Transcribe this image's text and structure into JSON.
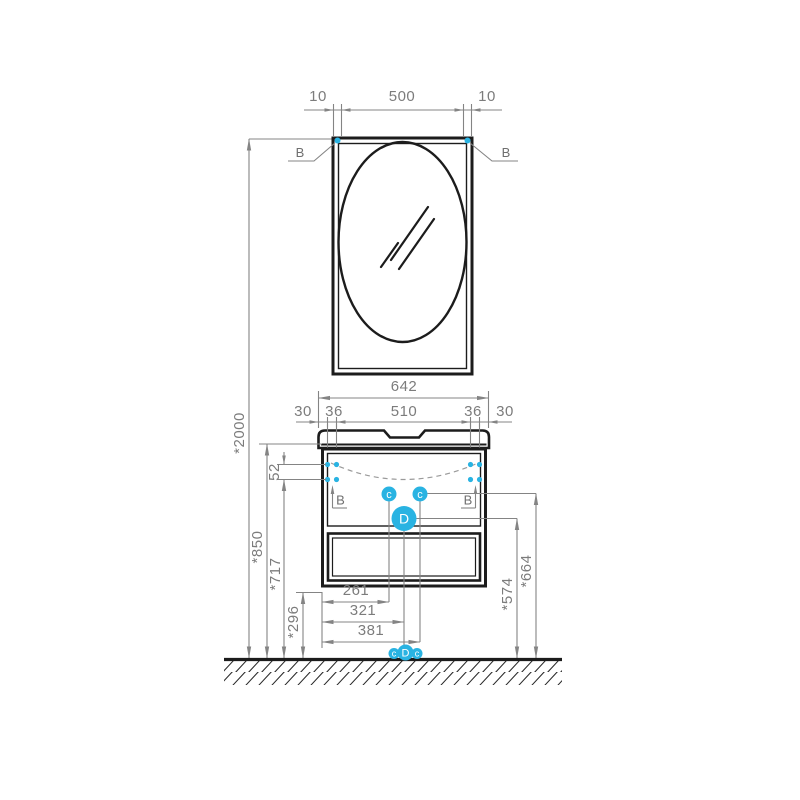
{
  "palette": {
    "accent": "#29b3e2",
    "ink": "#1c1c1c",
    "dim_gray": "#848484",
    "text_gray": "#7c7c7c"
  },
  "top_dims": {
    "left_offset": "10",
    "width": "500",
    "right_offset": "10"
  },
  "mirror": {
    "mount_left": "B",
    "mount_right": "B"
  },
  "width_dims": {
    "total": "642",
    "seg_30_l": "30",
    "seg_36_l": "36",
    "seg_510": "510",
    "seg_36_r": "36",
    "seg_30_r": "30"
  },
  "cabinet": {
    "mount_left": "B",
    "mount_right": "B",
    "supply_left": "c",
    "supply_right": "c",
    "drain": "D"
  },
  "height_dims": {
    "mirror_top": "*2000",
    "counter": "*850",
    "mounts": "*717",
    "mount_gap": "52",
    "cabinet_bottom": "*296",
    "drain": "*574",
    "supply": "*664"
  },
  "offset_dims": {
    "d1": "261",
    "d2": "321",
    "d3": "381"
  },
  "floor_markers": {
    "left": "c",
    "center": "D",
    "right": "c"
  }
}
